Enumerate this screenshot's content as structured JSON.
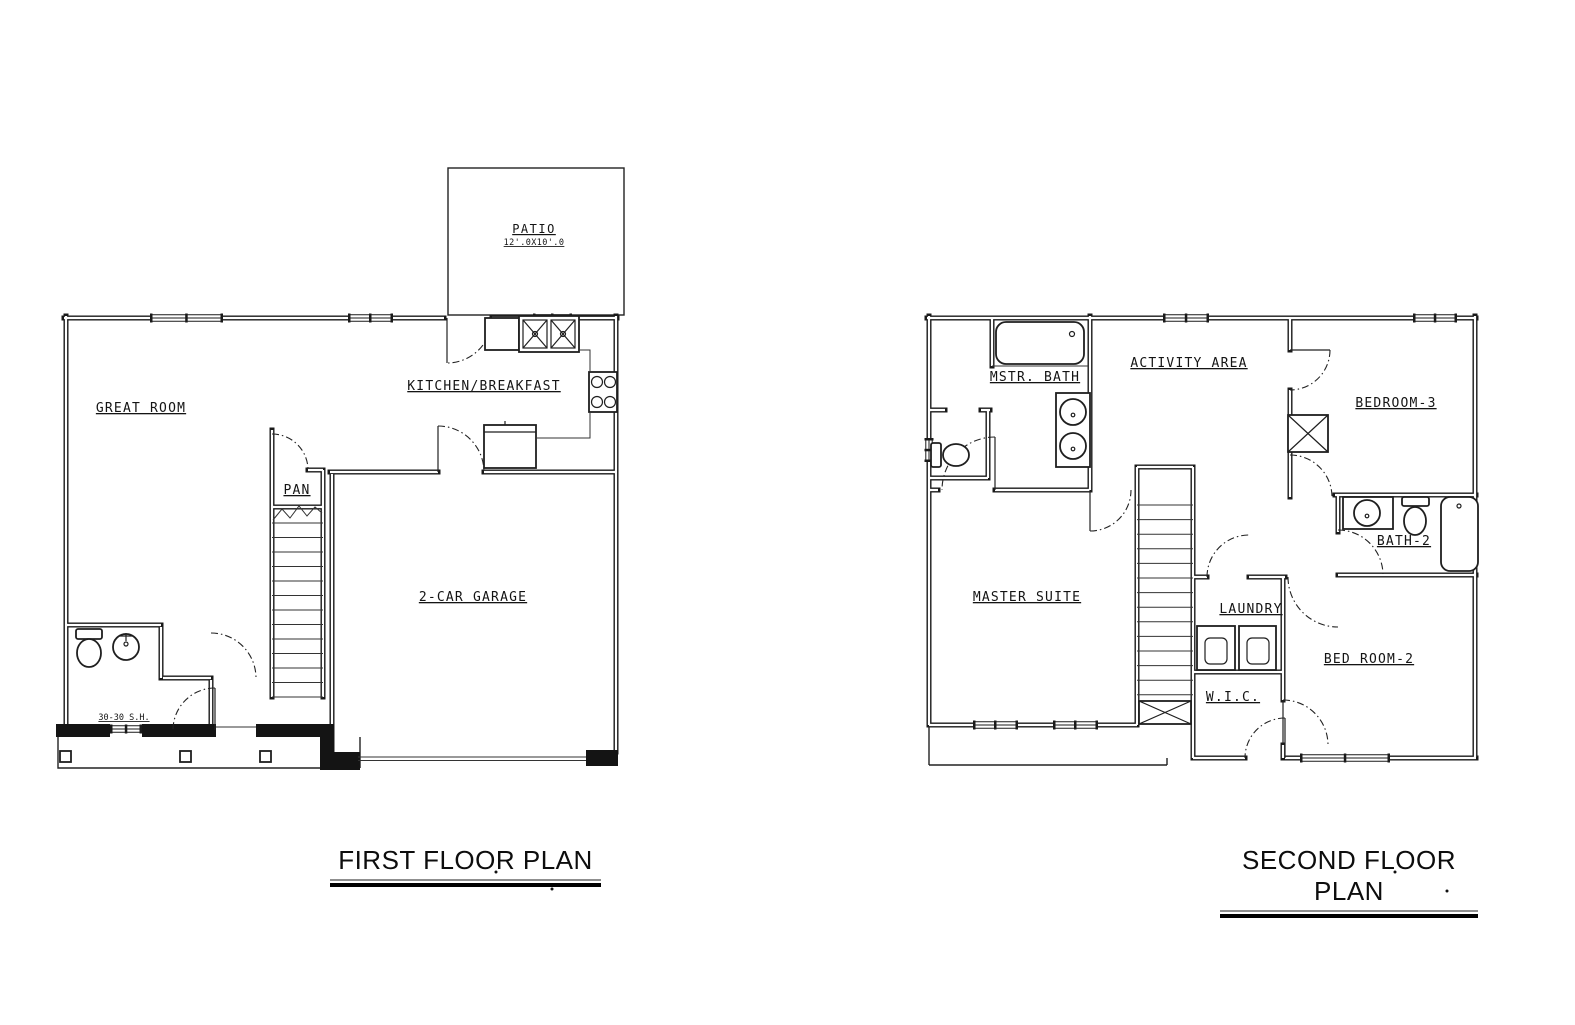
{
  "drawing": {
    "background": "#ffffff",
    "line_color": "#1a1a1a",
    "first_floor": {
      "title": "FIRST FLOOR PLAN",
      "patio": {
        "label": "PATIO",
        "size": "12'.0X10'.0"
      },
      "rooms": {
        "great_room": "GREAT ROOM",
        "kitchen": "KITCHEN/BREAKFAST",
        "pantry": "PAN",
        "garage": "2-CAR GARAGE"
      },
      "annotations": {
        "front_window": "30-30 S.H."
      },
      "fixtures": [
        "double-kitchen-sink",
        "range",
        "refrigerator",
        "toilet",
        "lavatory-sink",
        "stairs",
        "porch-posts"
      ]
    },
    "second_floor": {
      "title": "SECOND FLOOR PLAN",
      "rooms": {
        "master_bath": "MSTR. BATH",
        "activity_area": "ACTIVITY AREA",
        "bedroom_3": "BEDROOM-3",
        "bath_2": "BATH-2",
        "master_suite": "MASTER SUITE",
        "laundry": "LAUNDRY",
        "wic": "W.I.C.",
        "bedroom_2": "BED ROOM-2"
      },
      "fixtures": [
        "bathtub",
        "double-vanity",
        "toilet",
        "vanity-sink",
        "tub",
        "washer",
        "dryer",
        "stairs",
        "closet"
      ]
    }
  }
}
